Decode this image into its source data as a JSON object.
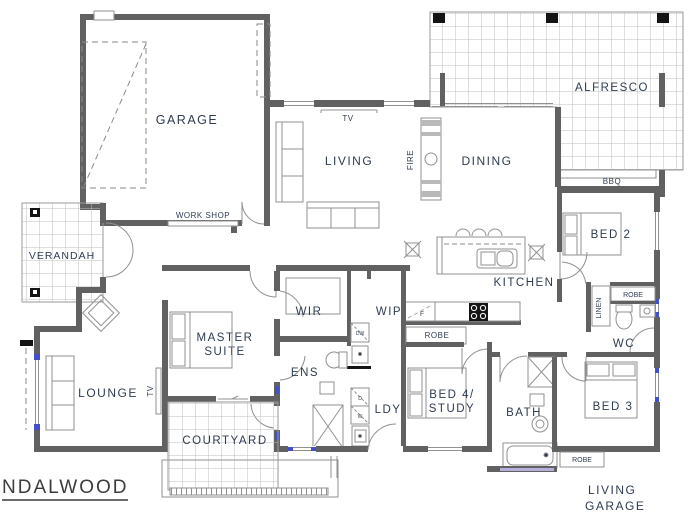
{
  "plan": {
    "title": "NDALWOOD",
    "note_line1": "LIVING",
    "note_line2": "GARAGE"
  },
  "labels": {
    "garage": "GARAGE",
    "workshop": "WORK SHOP",
    "verandah": "VERANDAH",
    "tv_living": "TV",
    "living": "LIVING",
    "fire": "FIRE",
    "dining": "DINING",
    "alfresco": "ALFRESCO",
    "bbq": "BBQ",
    "bed2": "BED 2",
    "kitchen": "KITCHEN",
    "wip": "WIP",
    "wir": "WIR",
    "master_line1": "MASTER",
    "master_line2": "SUITE",
    "ens": "ENS",
    "tv_lounge": "TV",
    "lounge": "LOUNGE",
    "courtyard": "COURTYARD",
    "ldy": "LDY",
    "bed4_line1": "BED 4/",
    "bed4_line2": "STUDY",
    "bath": "BATH",
    "bed3": "BED 3",
    "wc": "WC",
    "linen": "LINEN",
    "robe_hall": "ROBE",
    "robe_bed4": "ROBE",
    "robe_bed3": "ROBE",
    "fridge": "F",
    "dishwasher": "DW",
    "dryer": "D",
    "washer": "W"
  },
  "colors": {
    "wall": "#616161",
    "label_text": "#2e3c50",
    "window_accent": "#4450c8",
    "tub_accent": "#b7aede"
  }
}
